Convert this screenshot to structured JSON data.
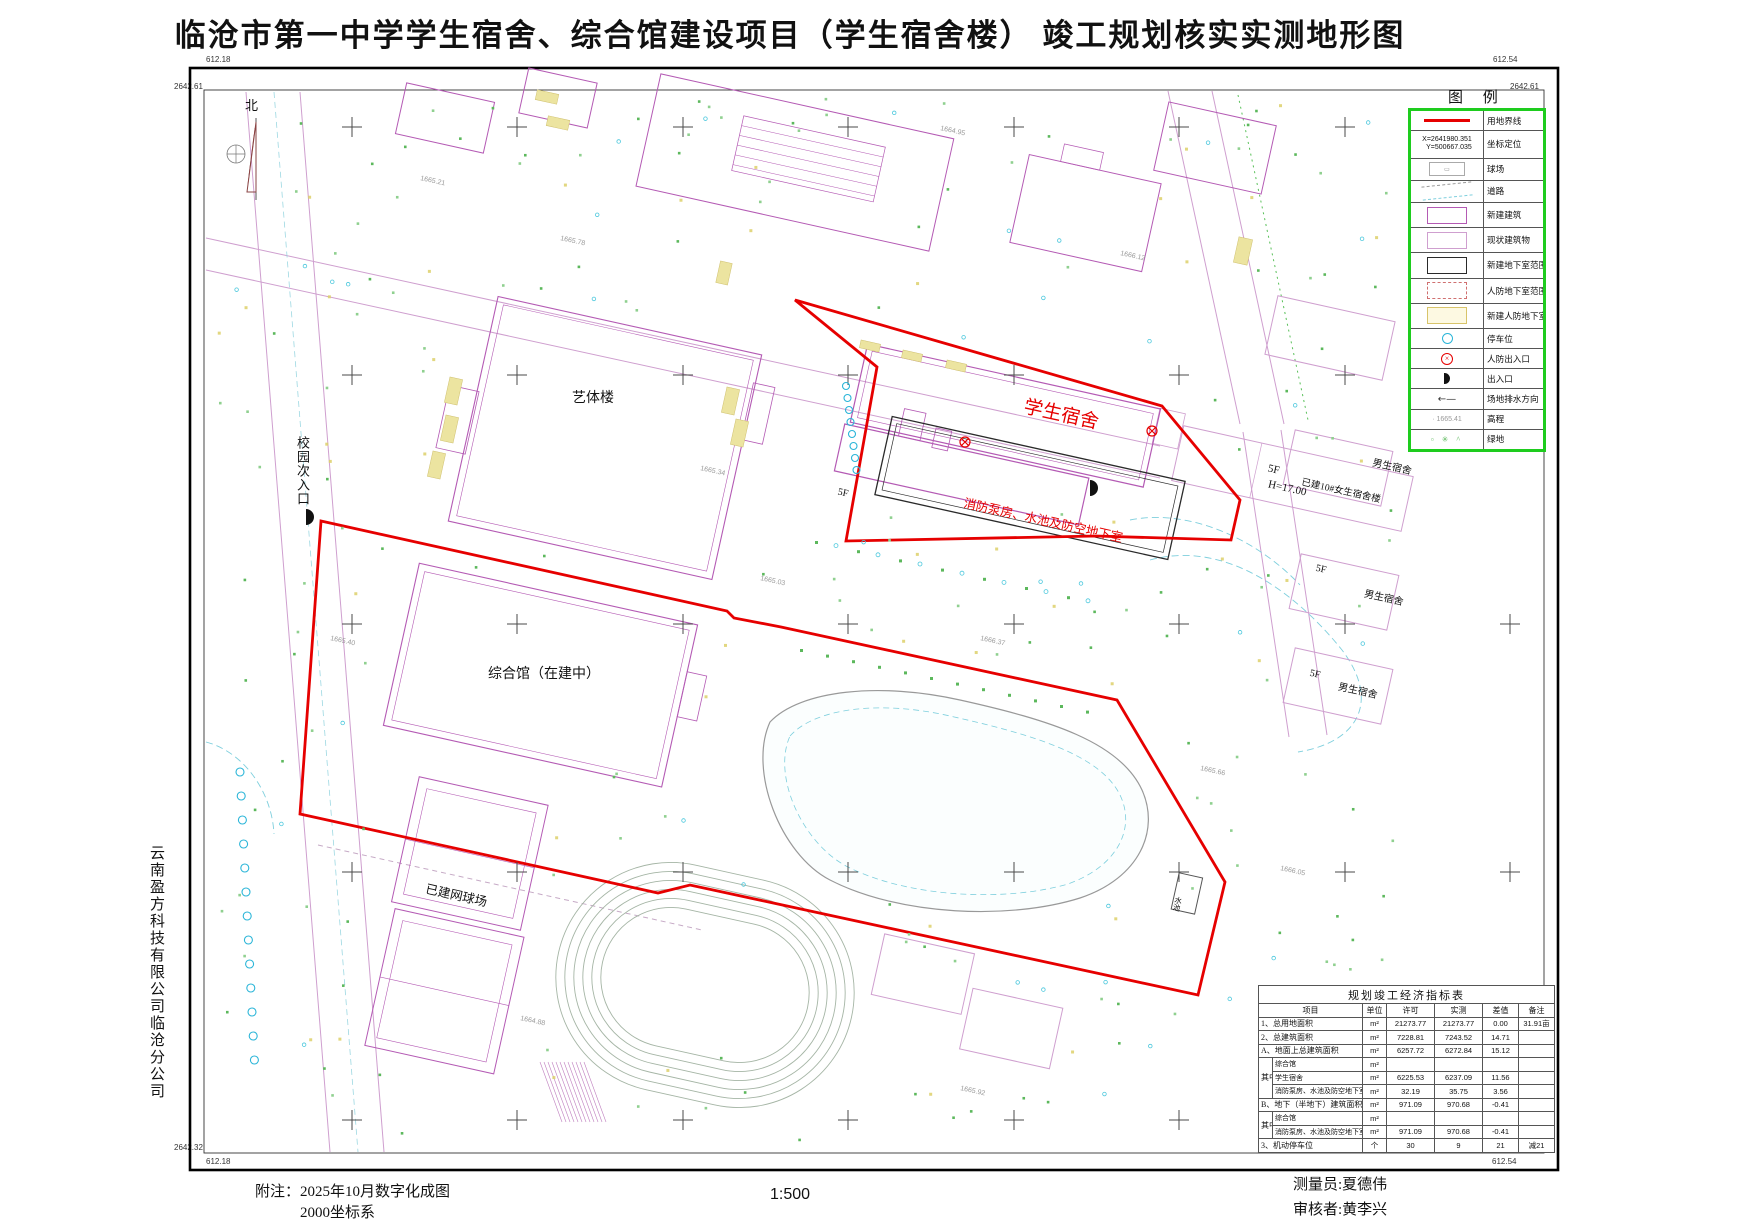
{
  "title": "临沧市第一中学学生宿舍、综合馆建设项目（学生宿舍楼） 竣工规划核实实测地形图",
  "colors": {
    "boundary_red": "#e60000",
    "building_magenta": "#b45ab4",
    "existing_magenta": "#cf9fcf",
    "legend_green": "#1ecc1e",
    "water_cyan": "#2ab5d8",
    "green_dot": "#5cb85c",
    "yellow_patch": "#ece4a0"
  },
  "corner_coords": {
    "top_left_x": "612.18",
    "top_left_y": "2642.61",
    "top_right_x": "612.54",
    "top_right_y": "2642.61",
    "bottom_left_y": "2642.32",
    "bottom_left_x": "612.18",
    "bottom_right_y": "2642.32",
    "bottom_right_x": "612.54"
  },
  "north_label": "北",
  "company_vertical": "云南盈方科技有限公司临沧分公司",
  "map_labels": {
    "yitilou": "艺体楼",
    "zonghedian": "综合馆（在建中）",
    "xuesheng_sushe": "学生宿舍",
    "xiaofang": "消防泵房、水池及防空地下室",
    "tennis": "已建网球场",
    "campus_entrance": "校园次入口",
    "boys1": "男生宿舍",
    "boys2": "男生宿舍",
    "boys3": "男生宿舍",
    "girls10": "已建10#女生宿舍楼",
    "f5_a": "5F",
    "f5_b": "5F",
    "f5_c": "5F",
    "f5_main": "5F",
    "height_main": "H=17.00",
    "pool": "水池",
    "elevations": [
      "1665.21",
      "1665.78",
      "1664.95",
      "1666.12",
      "1665.40",
      "1665.03",
      "1666.37",
      "1665.66",
      "1664.88",
      "1665.92",
      "1666.05",
      "1665.34"
    ]
  },
  "legend": {
    "title": "图 例",
    "coord_line1": "X=2641980.351",
    "coord_line2": "Y=500667.035",
    "elev_sample": "1665.41",
    "items": [
      {
        "sym": "redline",
        "label": "用地界线"
      },
      {
        "sym": "coords",
        "label": "坐标定位"
      },
      {
        "sym": "court",
        "label": "球场"
      },
      {
        "sym": "road",
        "label": "道路"
      },
      {
        "sym": "newbld",
        "label": "新建建筑"
      },
      {
        "sym": "existbld",
        "label": "现状建筑物"
      },
      {
        "sym": "basement",
        "label": "新建地下室范围线"
      },
      {
        "sym": "civildef",
        "label": "人防地下室范围线"
      },
      {
        "sym": "newcivil",
        "label": "新建人防地下室范围线"
      },
      {
        "sym": "parking",
        "label": "停车位"
      },
      {
        "sym": "civilentry",
        "label": "人防出入口"
      },
      {
        "sym": "entry",
        "label": "出入口"
      },
      {
        "sym": "drain",
        "label": "场地排水方向"
      },
      {
        "sym": "elev",
        "label": "高程"
      },
      {
        "sym": "green",
        "label": "绿地"
      }
    ]
  },
  "table": {
    "title": "规划竣工经济指标表",
    "group_label": "其中",
    "headers": [
      "项目",
      "单位",
      "许可",
      "实测",
      "差值",
      "备注"
    ],
    "rows": [
      {
        "type": "main",
        "cells": [
          "1、总用地面积",
          "m²",
          "21273.77",
          "21273.77",
          "0.00",
          "31.91亩"
        ]
      },
      {
        "type": "main",
        "cells": [
          "2、总建筑面积",
          "m²",
          "7228.81",
          "7243.52",
          "14.71",
          ""
        ]
      },
      {
        "type": "main",
        "cells": [
          "A、地面上总建筑面积",
          "m²",
          "6257.72",
          "6272.84",
          "15.12",
          ""
        ]
      },
      {
        "type": "sub",
        "groupStart": 3,
        "cells": [
          "综合馆",
          "m²",
          "",
          "",
          "",
          ""
        ]
      },
      {
        "type": "sub",
        "cells": [
          "学生宿舍",
          "m²",
          "6225.53",
          "6237.09",
          "11.56",
          ""
        ]
      },
      {
        "type": "sub",
        "cells": [
          "消防泵房、水池及防空地下室",
          "m²",
          "32.19",
          "35.75",
          "3.56",
          ""
        ]
      },
      {
        "type": "main",
        "cells": [
          "B、地下（半地下）建筑面积",
          "m²",
          "971.09",
          "970.68",
          "-0.41",
          ""
        ]
      },
      {
        "type": "sub",
        "groupStart": 2,
        "cells": [
          "综合馆",
          "m²",
          "",
          "",
          "",
          ""
        ]
      },
      {
        "type": "sub",
        "cells": [
          "消防泵房、水池及防空地下室",
          "m²",
          "971.09",
          "970.68",
          "-0.41",
          ""
        ]
      },
      {
        "type": "main",
        "cells": [
          "3、机动停车位",
          "个",
          "30",
          "9",
          "21",
          "减21"
        ]
      }
    ]
  },
  "footer": {
    "note_label": "附注：",
    "note_line1": "2025年10月数字化成图",
    "note_line2": "2000坐标系",
    "scale": "1:500",
    "surveyor": "测量员:夏德伟",
    "reviewer": "审核者:黄李兴"
  }
}
